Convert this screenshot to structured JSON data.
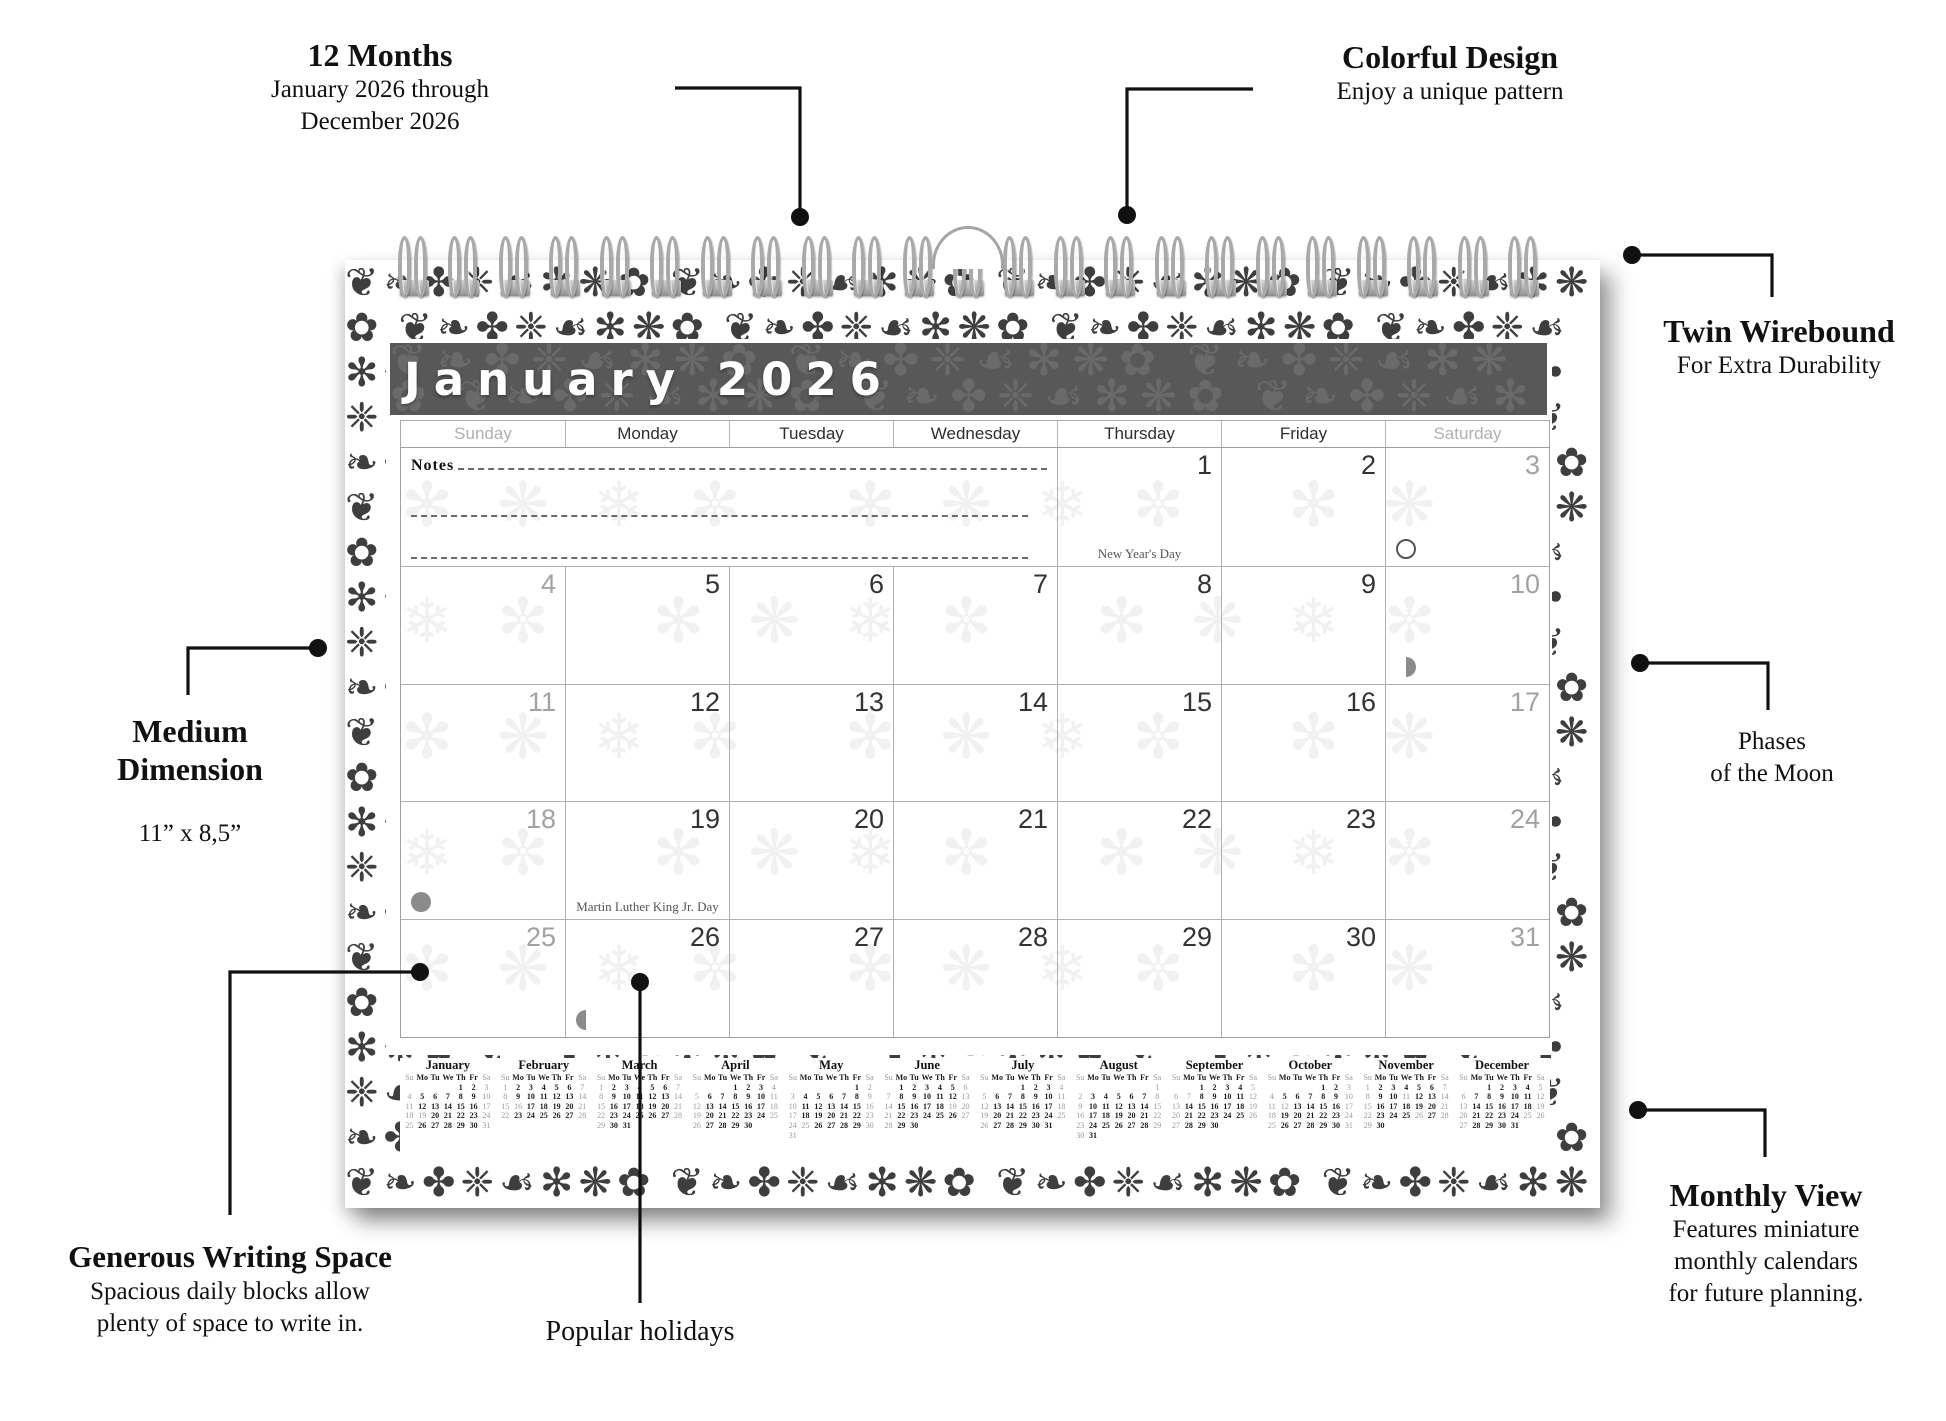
{
  "calendar": {
    "title": "January 2026",
    "weekdays": [
      "Sunday",
      "Monday",
      "Tuesday",
      "Wednesday",
      "Thursday",
      "Friday",
      "Saturday"
    ],
    "notes_label": "Notes",
    "weeks": [
      {
        "notes": true,
        "start_col": 4,
        "cells": [
          {
            "day": 1,
            "holiday": "New Year's Day"
          },
          {
            "day": 2
          },
          {
            "day": 3,
            "moon": "full"
          }
        ]
      },
      {
        "start_col": 0,
        "cells": [
          {
            "day": 4
          },
          {
            "day": 5
          },
          {
            "day": 6
          },
          {
            "day": 7
          },
          {
            "day": 8
          },
          {
            "day": 9
          },
          {
            "day": 10,
            "moon": "last_quarter"
          }
        ]
      },
      {
        "start_col": 0,
        "cells": [
          {
            "day": 11
          },
          {
            "day": 12
          },
          {
            "day": 13
          },
          {
            "day": 14
          },
          {
            "day": 15
          },
          {
            "day": 16
          },
          {
            "day": 17
          }
        ]
      },
      {
        "start_col": 0,
        "cells": [
          {
            "day": 18,
            "moon": "new"
          },
          {
            "day": 19,
            "holiday": "Martin Luther King Jr. Day"
          },
          {
            "day": 20
          },
          {
            "day": 21
          },
          {
            "day": 22
          },
          {
            "day": 23
          },
          {
            "day": 24
          }
        ]
      },
      {
        "start_col": 0,
        "cells": [
          {
            "day": 25
          },
          {
            "day": 26,
            "moon": "first_quarter"
          },
          {
            "day": 27
          },
          {
            "day": 28
          },
          {
            "day": 29
          },
          {
            "day": 30
          },
          {
            "day": 31
          }
        ]
      }
    ],
    "moon_phases_shown": {
      "full": 3,
      "last_quarter": 10,
      "new": 18,
      "first_quarter": 26
    }
  },
  "mini_calendars": {
    "weekday_header": [
      "Su",
      "Mo",
      "Tu",
      "We",
      "Th",
      "Fr",
      "Sa"
    ],
    "months": [
      {
        "name": "January",
        "start": 4,
        "days": 31,
        "gray_days": [
          19
        ]
      },
      {
        "name": "February",
        "start": 0,
        "days": 28,
        "gray_days": [
          16
        ]
      },
      {
        "name": "March",
        "start": 0,
        "days": 31,
        "gray_days": []
      },
      {
        "name": "April",
        "start": 3,
        "days": 30,
        "gray_days": []
      },
      {
        "name": "May",
        "start": 5,
        "days": 31,
        "gray_days": [
          25
        ]
      },
      {
        "name": "June",
        "start": 1,
        "days": 30,
        "gray_days": [
          19
        ]
      },
      {
        "name": "July",
        "start": 3,
        "days": 31,
        "gray_days": []
      },
      {
        "name": "August",
        "start": 6,
        "days": 31,
        "gray_days": []
      },
      {
        "name": "September",
        "start": 2,
        "days": 30,
        "gray_days": [
          7
        ]
      },
      {
        "name": "October",
        "start": 4,
        "days": 31,
        "gray_days": [
          12
        ]
      },
      {
        "name": "November",
        "start": 0,
        "days": 30,
        "gray_days": [
          11,
          26
        ]
      },
      {
        "name": "December",
        "start": 2,
        "days": 31,
        "gray_days": [
          25
        ]
      }
    ]
  },
  "annotations": {
    "twelve_months": {
      "title": "12 Months",
      "line1": "January 2026 through",
      "line2": "December 2026"
    },
    "colorful_design": {
      "title": "Colorful Design",
      "line1": "Enjoy a unique pattern"
    },
    "twin_wirebound": {
      "title": "Twin Wirebound",
      "line1": "For Extra Durability"
    },
    "phases_moon": {
      "line1": "Phases",
      "line2": "of the Moon"
    },
    "medium_dimension": {
      "title_line1": "Medium",
      "title_line2": "Dimension",
      "size": "11” x 8,5”"
    },
    "generous_writing": {
      "title": "Generous Writing Space",
      "line1": "Spacious daily blocks allow",
      "line2": "plenty of space to write in."
    },
    "popular_holidays": {
      "label": "Popular holidays"
    },
    "monthly_view": {
      "title": "Monthly View",
      "line1": "Features miniature",
      "line2": "monthly calendars",
      "line3": "for future planning."
    }
  },
  "colors": {
    "title_bar": "#585858",
    "grid_border": "#b0b0b0",
    "weekday_date": "#333333",
    "weekend_date": "#a2a2a2",
    "ornament": "#2e2e2e",
    "callout": "#111111"
  },
  "ornaments": {
    "border_glyphs": "❦❧✤❈☙✻❋✿",
    "faint_glyphs": "✻❋❄✼"
  }
}
